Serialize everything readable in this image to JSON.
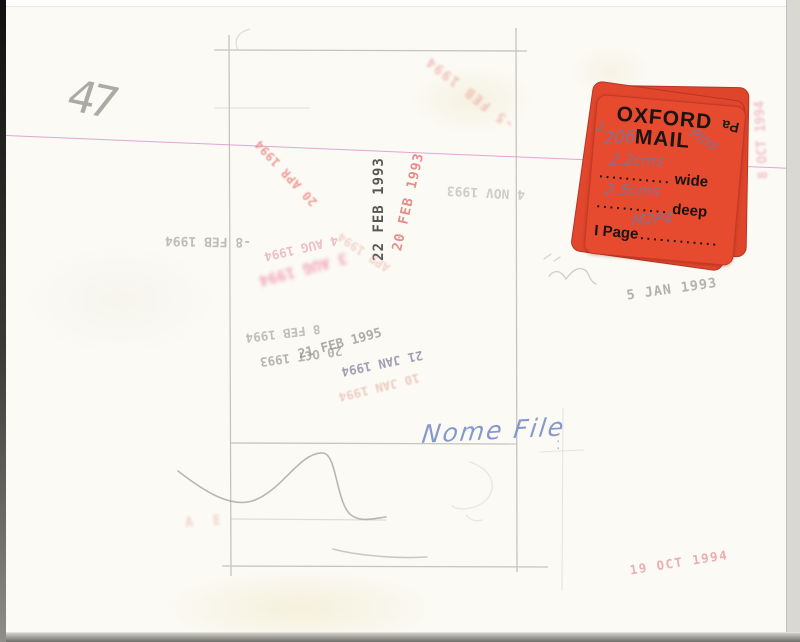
{
  "annotations": {
    "corner_number": "47",
    "file_note": "Nome File",
    "file_note_mark": ":",
    "fragment_marks": "A E"
  },
  "sticker": {
    "title_line1": "OXFORD",
    "title_line2": "MAIL",
    "flipped_fragment": "Pa",
    "rows": {
      "wide_dots": "...........",
      "wide_label": "wide",
      "deep_dots": "...........",
      "deep_label": "deep",
      "page_label": "I Page",
      "page_dots": "............"
    },
    "handwriting": {
      "small_digit": "2",
      "ref_number": "206",
      "pins": "Pins",
      "wide_value": "2.2cms",
      "deep_value": "2.5cms",
      "page_value": "M2P4"
    },
    "color": "#e64a2f"
  },
  "stamps": [
    {
      "text": "22 FEB 1993",
      "color": "#3b3b3b"
    },
    {
      "text": "20 FEB 1993",
      "color": "#dd7470"
    },
    {
      "text": "-5 FEB 1994",
      "color": "#e98a84"
    },
    {
      "text": "20 APR 1994",
      "color": "#ec8482"
    },
    {
      "text": "4 NOV 1993",
      "color": "#a39f9a"
    },
    {
      "text": "-8 FEB 1994",
      "color": "#a8a39d"
    },
    {
      "text": "4 AUG 1994",
      "color": "#eeadbe"
    },
    {
      "text": "3 AUG 1994",
      "color": "#ef93b0"
    },
    {
      "text": "APR 1994",
      "color": "#e89a94"
    },
    {
      "text": "8 FEB 1994",
      "color": "#a39e98"
    },
    {
      "text": "20 OCT 1993",
      "color": "#9b9691"
    },
    {
      "text": "21 FEB 1995",
      "color": "#9d9893"
    },
    {
      "text": "21 JAN 1994",
      "color": "#8f86a4"
    },
    {
      "text": "10 JAN 1994",
      "color": "#e39b95"
    },
    {
      "text": "5 JAN 1993",
      "color": "#aaa49e"
    },
    {
      "text": "8 OCT 1994",
      "color": "#efa0b4"
    },
    {
      "text": "8 OCT 1994",
      "color": "#f0a8be"
    },
    {
      "text": "19 OCT 1994",
      "color": "#e9a0a4"
    },
    {
      "text": "A E",
      "color": "#e08a84"
    }
  ],
  "colors": {
    "paper": "#fbfaf4",
    "magenta_line": "#cf63c1",
    "pencil": "#b5b3aa",
    "note_ink": "#7289c6",
    "sticker_handwriting_ink": "#7d7497"
  }
}
